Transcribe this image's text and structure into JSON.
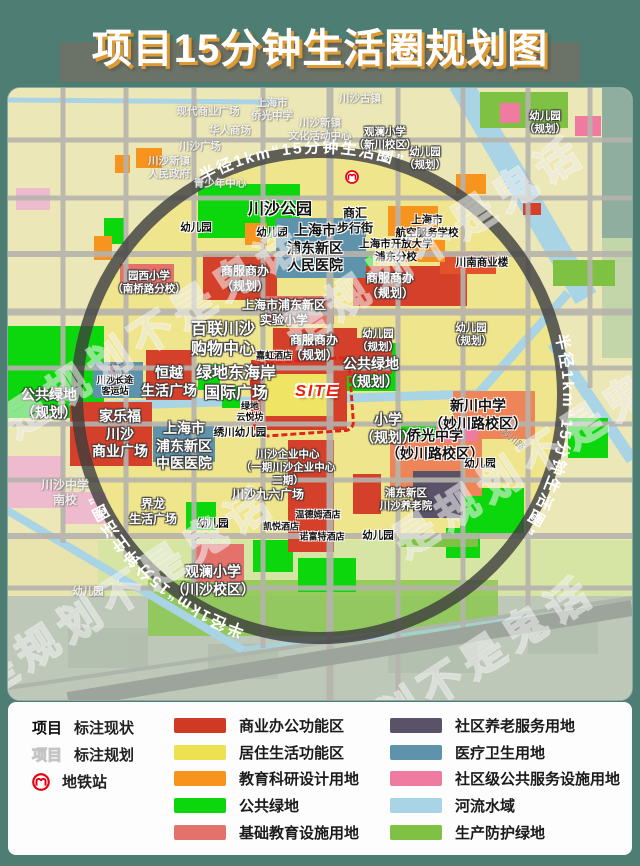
{
  "title": "项目15分钟生活圈规划图",
  "watermark": "是规划不是鬼话",
  "map": {
    "circle_label": "半径1km“15分钟生活圈”",
    "site_label": "SITE",
    "labels": [
      {
        "t": "现代商业广场",
        "x": 200,
        "y": 24,
        "c": "faint",
        "s": "sm"
      },
      {
        "t": "上海市\n侨光中学",
        "x": 264,
        "y": 22,
        "c": "faint",
        "s": "sm"
      },
      {
        "t": "川沙古镇",
        "x": 352,
        "y": 11,
        "c": "faint",
        "s": "sm"
      },
      {
        "t": "华人商场",
        "x": 222,
        "y": 43,
        "c": "faint",
        "s": "sm"
      },
      {
        "t": "川沙广场",
        "x": 192,
        "y": 59,
        "c": "faint",
        "s": "sm"
      },
      {
        "t": "川沙新镇\n人民政府",
        "x": 161,
        "y": 80,
        "c": "faint",
        "s": "sm"
      },
      {
        "t": "川沙新镇\n文化活动中心",
        "x": 312,
        "y": 42,
        "c": "faint",
        "s": "sm"
      },
      {
        "t": "青少年中心",
        "x": 212,
        "y": 96,
        "c": "faint",
        "s": "sm"
      },
      {
        "t": "川沙中学\n南校",
        "x": 57,
        "y": 405,
        "c": "faint",
        "s": "md"
      },
      {
        "t": "幼儿园",
        "x": 80,
        "y": 504,
        "c": "faint",
        "s": "sm"
      },
      {
        "t": "观澜小学\n（新川校区）",
        "x": 377,
        "y": 51,
        "c": "plan",
        "s": "sm"
      },
      {
        "t": "幼儿园\n（规划）",
        "x": 417,
        "y": 71,
        "c": "plan",
        "s": "sm"
      },
      {
        "t": "幼儿园\n（规划）",
        "x": 537,
        "y": 35,
        "c": "plan",
        "s": "sm"
      },
      {
        "t": "商服商办\n（规划）",
        "x": 237,
        "y": 191,
        "c": "plan",
        "s": "md"
      },
      {
        "t": "商服商办\n（规划）",
        "x": 382,
        "y": 198,
        "c": "plan",
        "s": "md"
      },
      {
        "t": "上海市浦东新区\n实验小学",
        "x": 276,
        "y": 225,
        "c": "plan",
        "s": "md"
      },
      {
        "t": "百联川沙\n购物中心",
        "x": 215,
        "y": 252,
        "c": "plan",
        "s": "xl"
      },
      {
        "t": "商服商办\n（规划）",
        "x": 306,
        "y": 260,
        "c": "plan",
        "s": "md"
      },
      {
        "t": "公共绿地\n（规划）",
        "x": 363,
        "y": 285,
        "c": "plan",
        "s": "lg"
      },
      {
        "t": "恒越\n生活广场",
        "x": 161,
        "y": 294,
        "c": "plan",
        "s": "lg"
      },
      {
        "t": "绿地东海岸\n国际广场",
        "x": 228,
        "y": 296,
        "c": "plan",
        "s": "xl"
      },
      {
        "t": "公共绿地\n（规划）",
        "x": 41,
        "y": 316,
        "c": "plan",
        "s": "lg"
      },
      {
        "t": "家乐福\n川沙\n商业广场",
        "x": 112,
        "y": 346,
        "c": "plan",
        "s": "lg"
      },
      {
        "t": "上海市\n浦东新区\n中医医院",
        "x": 176,
        "y": 358,
        "c": "plan",
        "s": "lg"
      },
      {
        "t": "小学\n（规划）",
        "x": 380,
        "y": 341,
        "c": "plan",
        "s": "lg"
      },
      {
        "t": "川沙企业中心\n（一期川沙企业中心\n二期）",
        "x": 280,
        "y": 380,
        "c": "plan",
        "s": "sm"
      },
      {
        "t": "川沙九六广场",
        "x": 260,
        "y": 407,
        "c": "plan",
        "s": "md"
      },
      {
        "t": "浦东新区\n川沙养老院",
        "x": 398,
        "y": 412,
        "c": "plan",
        "s": "sm"
      },
      {
        "t": "界龙\n生活广场",
        "x": 145,
        "y": 424,
        "c": "plan",
        "s": "md"
      },
      {
        "t": "观澜小学\n（川沙校区）",
        "x": 205,
        "y": 493,
        "c": "plan",
        "s": "lg"
      },
      {
        "t": "园西小学\n（南桥路分校）",
        "x": 141,
        "y": 195,
        "c": "plan",
        "s": "sm"
      },
      {
        "t": "幼儿园\n（规划）",
        "x": 370,
        "y": 253,
        "c": "plan",
        "s": "sm"
      },
      {
        "t": "幼儿园\n（规划）",
        "x": 463,
        "y": 247,
        "c": "plan",
        "s": "sm"
      },
      {
        "t": "川沙长途\n客运站",
        "x": 107,
        "y": 298,
        "c": "cur",
        "s": "xs"
      },
      {
        "t": "绿地\n云悦坊",
        "x": 242,
        "y": 324,
        "c": "cur",
        "s": "xs"
      },
      {
        "t": "绣川幼儿园",
        "x": 232,
        "y": 345,
        "c": "cur",
        "s": "sm"
      },
      {
        "t": "侨光中学\n（妙川路校区）",
        "x": 427,
        "y": 357,
        "c": "cur",
        "s": "lg"
      },
      {
        "t": "新川中学\n（妙川路校区）",
        "x": 470,
        "y": 327,
        "c": "cur",
        "s": "lg"
      },
      {
        "t": "幼儿园",
        "x": 472,
        "y": 376,
        "c": "cur",
        "s": "sm"
      },
      {
        "t": "幼儿园",
        "x": 205,
        "y": 436,
        "c": "cur",
        "s": "sm"
      },
      {
        "t": "温德姆酒店",
        "x": 310,
        "y": 427,
        "c": "cur",
        "s": "xs"
      },
      {
        "t": "凯悦酒店",
        "x": 273,
        "y": 439,
        "c": "cur",
        "s": "xs"
      },
      {
        "t": "诺富特酒店",
        "x": 314,
        "y": 449,
        "c": "cur",
        "s": "xs"
      },
      {
        "t": "幼儿园",
        "x": 370,
        "y": 448,
        "c": "cur",
        "s": "sm"
      },
      {
        "t": "川沙公园",
        "x": 272,
        "y": 122,
        "c": "cur",
        "s": "xl"
      },
      {
        "t": "幼儿园",
        "x": 188,
        "y": 140,
        "c": "cur",
        "s": "sm"
      },
      {
        "t": "幼儿园",
        "x": 264,
        "y": 145,
        "c": "cur",
        "s": "sm"
      },
      {
        "t": "上海市\n浦东新区\n人民医院",
        "x": 307,
        "y": 160,
        "c": "cur",
        "s": "lg"
      },
      {
        "t": "商汇\n步行街",
        "x": 347,
        "y": 133,
        "c": "cur",
        "s": "md"
      },
      {
        "t": "上海市\n航空服务学校",
        "x": 419,
        "y": 139,
        "c": "cur",
        "s": "sm"
      },
      {
        "t": "上海市开放大学\n浦东分校",
        "x": 388,
        "y": 163,
        "c": "cur",
        "s": "sm"
      },
      {
        "t": "川南商业楼",
        "x": 474,
        "y": 175,
        "c": "cur",
        "s": "sm"
      },
      {
        "t": "嘉虹酒店",
        "x": 266,
        "y": 268,
        "c": "cur",
        "s": "xs"
      },
      {
        "t": "妙川路",
        "x": 505,
        "y": 352,
        "c": "road",
        "s": "xs",
        "r": 40
      },
      {
        "t": "SITE",
        "x": 309,
        "y": 304,
        "c": "site",
        "s": "xl"
      }
    ]
  },
  "legend": {
    "marker_current": {
      "sample": "项目",
      "label": "标注现状"
    },
    "marker_planned": {
      "sample": "项目",
      "label": "标注规划"
    },
    "metro_label": "地铁站",
    "items_left": [
      {
        "label": "商业办公功能区",
        "color": "#cf3a25"
      },
      {
        "label": "居住生活功能区",
        "color": "#ece150"
      },
      {
        "label": "教育科研设计用地",
        "color": "#f7941e"
      },
      {
        "label": "公共绿地",
        "color": "#0cd60c"
      },
      {
        "label": "基础教育设施用地",
        "color": "#e5716b"
      }
    ],
    "items_right": [
      {
        "label": "社区养老服务用地",
        "color": "#5a5268"
      },
      {
        "label": "医疗卫生用地",
        "color": "#5f93ac"
      },
      {
        "label": "社区级公共服务设施用地",
        "color": "#f07ba0"
      },
      {
        "label": "河流水域",
        "color": "#a9d4e5"
      },
      {
        "label": "生产防护绿地",
        "color": "#7fc143"
      }
    ]
  }
}
